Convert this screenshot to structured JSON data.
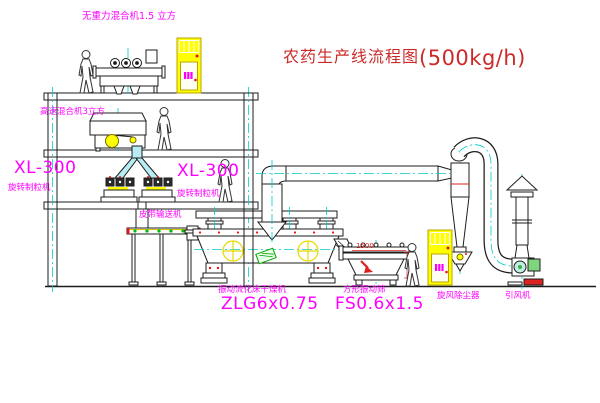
{
  "title": {
    "zh": "农药生产线流程图",
    "capacity": "(500kg/h)"
  },
  "labels": {
    "top_mixer": "无重力混合机1.5 立方",
    "second_mixer": "高速混合机3立方",
    "granulator_left": {
      "model": "XL-300",
      "name": "旋转制粒机"
    },
    "granulator_right": {
      "model": "XL-300",
      "name": "旋转制粒机"
    },
    "belt_conveyor": "皮带输送机",
    "dryer": {
      "name": "振动流化床干燥机",
      "model": "ZLG6x0.75"
    },
    "sieve": {
      "name": "方形振动筛",
      "model": "FS0.6x1.5",
      "dimension": "1500"
    },
    "cyclone": "旋风除尘器",
    "fan": "引风机"
  },
  "colors": {
    "label_magenta": "#ff00ff",
    "title_red": "#cc2a2a",
    "line_black": "#1c1c1c",
    "centerline_cyan": "#00cccc",
    "cabinet_yellow": "#ffff00",
    "symbol_yellow": "#e8d900",
    "accent_green": "#00bb00",
    "accent_red": "#ee1111",
    "pipe_cyan_fill": "#b8ecf4"
  }
}
